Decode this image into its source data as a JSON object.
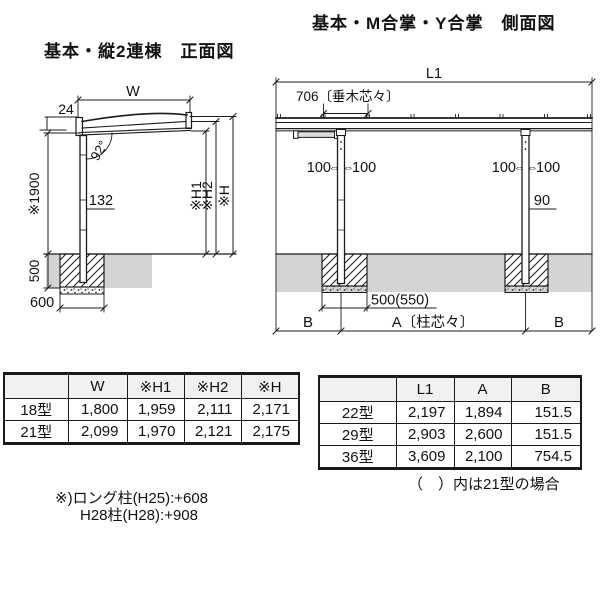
{
  "titles": {
    "front": "基本・縦2連棟　正面図",
    "side": "基本・M合掌・Y合掌　側面図"
  },
  "front": {
    "w": "W",
    "d24": "24",
    "angle": "92°",
    "h1900": "※1900",
    "d132": "132",
    "h1": "※H1",
    "h2": "※H2",
    "h": "※H",
    "d500": "500",
    "d600": "600"
  },
  "side": {
    "l1": "L1",
    "rafter": "706〔垂木芯々〕",
    "d100": "100",
    "arrow": "⇔",
    "d90": "90",
    "found": "500(550)",
    "a": "A〔柱芯々〕",
    "b": "B"
  },
  "tables": {
    "left": {
      "headers": [
        "",
        "W",
        "※H1",
        "※H2",
        "※H"
      ],
      "rows": [
        {
          "label": "18型",
          "values": [
            "1,800",
            "1,959",
            "2,111",
            "2,171"
          ]
        },
        {
          "label": "21型",
          "values": [
            "2,099",
            "1,970",
            "2,121",
            "2,175"
          ]
        }
      ]
    },
    "right": {
      "headers": [
        "",
        "L1",
        "A",
        "B"
      ],
      "rows": [
        {
          "label": "22型",
          "values": [
            "2,197",
            "1,894",
            "151.5"
          ]
        },
        {
          "label": "29型",
          "values": [
            "2,903",
            "2,600",
            "151.5"
          ]
        },
        {
          "label": "36型",
          "values": [
            "3,609",
            "2,100",
            "754.5"
          ]
        }
      ]
    }
  },
  "notes": {
    "paren": "（　）内は21型の場合",
    "long_post": "※)ロング柱(H25):+608",
    "h28_post": "H28柱(H28):+908"
  },
  "colors": {
    "line": "#1c1c1c",
    "ground": "#d4d4d4",
    "table_header_bg": "#f1f1f1"
  }
}
